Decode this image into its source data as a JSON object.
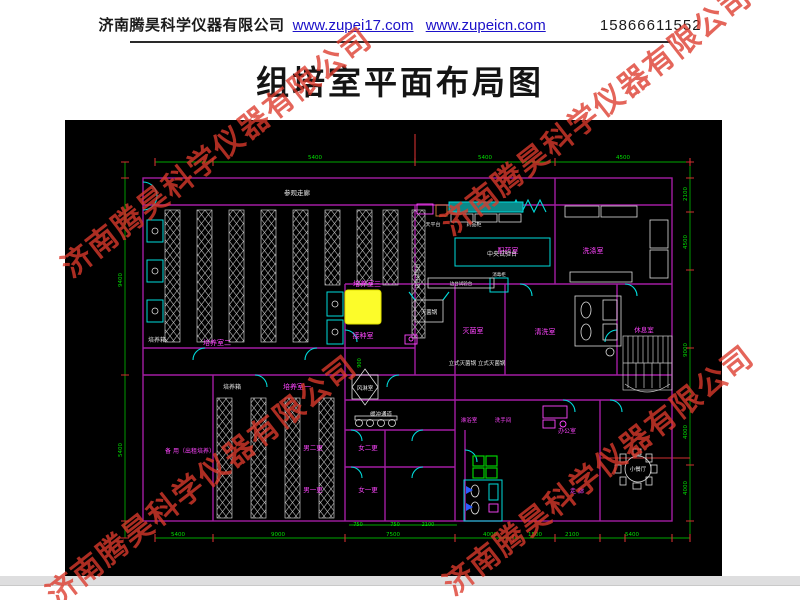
{
  "header": {
    "company": "济南腾昊科学仪器有限公司",
    "url1": "www.zupei17.com",
    "url2": "www.zupeicn.com",
    "phone": "15866611552"
  },
  "title": "组培室平面布局图",
  "watermark": {
    "text": "济南腾昊科学仪器有限公司",
    "color": "#dd3a2c",
    "positions": [
      {
        "x": 215,
        "y": 150
      },
      {
        "x": 595,
        "y": 108
      },
      {
        "x": 200,
        "y": 478
      },
      {
        "x": 597,
        "y": 468
      }
    ]
  },
  "colors": {
    "m": "#ff45ff",
    "w": "#e8e8e8",
    "g": "#00e000",
    "wall": "#a21ca2",
    "door": "#00dcdc",
    "dim": "#00a800",
    "tick": "#d03030",
    "rack": "#c8c8c8",
    "highlight": "#fcfc2a"
  },
  "floorplan": {
    "labels": [
      {
        "t": "参观走廊",
        "x": 232,
        "y": 75,
        "c": "w",
        "s": 6.5
      },
      {
        "t": "培养室三",
        "x": 302,
        "y": 166,
        "c": "m",
        "s": 7
      },
      {
        "t": "培养室二",
        "x": 152,
        "y": 225,
        "c": "m",
        "s": 7
      },
      {
        "t": "培养箱",
        "x": 92,
        "y": 222,
        "c": "w",
        "s": 6
      },
      {
        "t": "培养室一",
        "x": 232,
        "y": 269,
        "c": "m",
        "s": 7
      },
      {
        "t": "培养箱",
        "x": 167,
        "y": 269,
        "c": "w",
        "s": 6
      },
      {
        "t": "接种室",
        "x": 298,
        "y": 218,
        "c": "m",
        "s": 7
      },
      {
        "t": "灭菌锅",
        "x": 364,
        "y": 194,
        "c": "w",
        "s": 5.5
      },
      {
        "t": "灭菌室",
        "x": 408,
        "y": 213,
        "c": "m",
        "s": 7
      },
      {
        "t": "立式灭菌锅 立式灭菌锅",
        "x": 412,
        "y": 245,
        "c": "w",
        "s": 5.5
      },
      {
        "t": "风淋室",
        "x": 300,
        "y": 270,
        "c": "w",
        "s": 5.5
      },
      {
        "t": "缓冲通道",
        "x": 316,
        "y": 296,
        "c": "w",
        "s": 5.5
      },
      {
        "t": "男二更",
        "x": 248,
        "y": 330,
        "c": "m",
        "s": 6.5
      },
      {
        "t": "女二更",
        "x": 303,
        "y": 330,
        "c": "m",
        "s": 6.5
      },
      {
        "t": "男一更",
        "x": 248,
        "y": 372,
        "c": "m",
        "s": 6.5
      },
      {
        "t": "女一更",
        "x": 303,
        "y": 372,
        "c": "m",
        "s": 6.5
      },
      {
        "t": "备 用（出租培养）",
        "x": 125,
        "y": 333,
        "c": "m",
        "s": 6
      },
      {
        "t": "配药室",
        "x": 443,
        "y": 133,
        "c": "m",
        "s": 7
      },
      {
        "t": "中央试验台",
        "x": 437,
        "y": 136,
        "c": "w",
        "s": 6
      },
      {
        "t": "洗涤室",
        "x": 528,
        "y": 133,
        "c": "m",
        "s": 7
      },
      {
        "t": "清洗室",
        "x": 480,
        "y": 214,
        "c": "m",
        "s": 7
      },
      {
        "t": "休息室",
        "x": 579,
        "y": 212,
        "c": "m",
        "s": 6.5
      },
      {
        "t": "淋浴室",
        "x": 404,
        "y": 302,
        "c": "m",
        "s": 5.5
      },
      {
        "t": "洗手间",
        "x": 438,
        "y": 302,
        "c": "m",
        "s": 5.5
      },
      {
        "t": "办公室",
        "x": 502,
        "y": 313,
        "c": "m",
        "s": 6
      },
      {
        "t": "小餐厅",
        "x": 573,
        "y": 351,
        "c": "w",
        "s": 5.5
      },
      {
        "t": "走 廊",
        "x": 512,
        "y": 373,
        "c": "m",
        "s": 6
      },
      {
        "t": "边台试验台",
        "x": 354,
        "y": 156,
        "c": "w",
        "s": 5,
        "r": -90
      },
      {
        "t": "边台试验台",
        "x": 396,
        "y": 165,
        "c": "w",
        "s": 4.5
      },
      {
        "t": "天平台",
        "x": 368,
        "y": 106,
        "c": "w",
        "s": 5
      },
      {
        "t": "药品柜",
        "x": 409,
        "y": 106,
        "c": "w",
        "s": 5
      },
      {
        "t": "消毒柜",
        "x": 434,
        "y": 156,
        "c": "w",
        "s": 4.5
      }
    ],
    "dims": [
      {
        "t": "5400",
        "x": 250,
        "y": 39,
        "c": "g",
        "s": 5.5
      },
      {
        "t": "5400",
        "x": 420,
        "y": 39,
        "c": "g",
        "s": 5.5
      },
      {
        "t": "4500",
        "x": 558,
        "y": 39,
        "c": "g",
        "s": 5.5
      },
      {
        "t": "9400",
        "x": 57,
        "y": 160,
        "c": "g",
        "s": 5.5,
        "r": -90
      },
      {
        "t": "5400",
        "x": 57,
        "y": 330,
        "c": "g",
        "s": 5.5,
        "r": -90
      },
      {
        "t": "2100",
        "x": 622,
        "y": 74,
        "c": "g",
        "s": 5.5,
        "r": -90
      },
      {
        "t": "4500",
        "x": 622,
        "y": 122,
        "c": "g",
        "s": 5.5,
        "r": -90
      },
      {
        "t": "9000",
        "x": 622,
        "y": 230,
        "c": "g",
        "s": 5.5,
        "r": -90
      },
      {
        "t": "4000",
        "x": 622,
        "y": 312,
        "c": "g",
        "s": 5.5,
        "r": -90
      },
      {
        "t": "4000",
        "x": 622,
        "y": 368,
        "c": "g",
        "s": 5.5,
        "r": -90
      },
      {
        "t": "5400",
        "x": 113,
        "y": 416,
        "c": "g",
        "s": 5.5
      },
      {
        "t": "9000",
        "x": 213,
        "y": 416,
        "c": "g",
        "s": 5.5
      },
      {
        "t": "7500",
        "x": 328,
        "y": 416,
        "c": "g",
        "s": 5.5
      },
      {
        "t": "4000",
        "x": 425,
        "y": 416,
        "c": "g",
        "s": 5.5
      },
      {
        "t": "1500",
        "x": 470,
        "y": 416,
        "c": "g",
        "s": 5.5
      },
      {
        "t": "2100",
        "x": 507,
        "y": 416,
        "c": "g",
        "s": 5.5
      },
      {
        "t": "5400",
        "x": 567,
        "y": 416,
        "c": "g",
        "s": 5.5
      },
      {
        "t": "750",
        "x": 293,
        "y": 406,
        "c": "g",
        "s": 5
      },
      {
        "t": "750",
        "x": 330,
        "y": 406,
        "c": "g",
        "s": 5
      },
      {
        "t": "2100",
        "x": 363,
        "y": 406,
        "c": "g",
        "s": 5
      },
      {
        "t": "900",
        "x": 296,
        "y": 243,
        "c": "g",
        "s": 5,
        "r": -90
      }
    ]
  }
}
